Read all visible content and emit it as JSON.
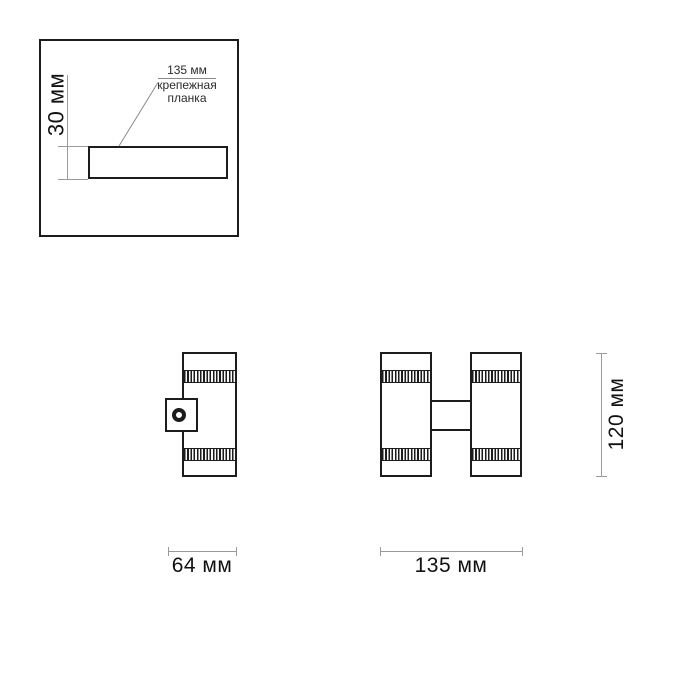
{
  "drawing": {
    "inset": {
      "height_label": "30 мм",
      "callout": {
        "line1": "135 мм",
        "line2": "крепежная",
        "line3": "планка"
      }
    },
    "side_view": {
      "width_label": "64 мм"
    },
    "front_view": {
      "width_label": "135 мм",
      "height_label": "120 мм"
    }
  },
  "colors": {
    "outline": "#1c1c1c",
    "dimension_line": "#9a9a9a",
    "leader_line": "#8a8a8a",
    "text": "#111111",
    "background": "#ffffff"
  }
}
